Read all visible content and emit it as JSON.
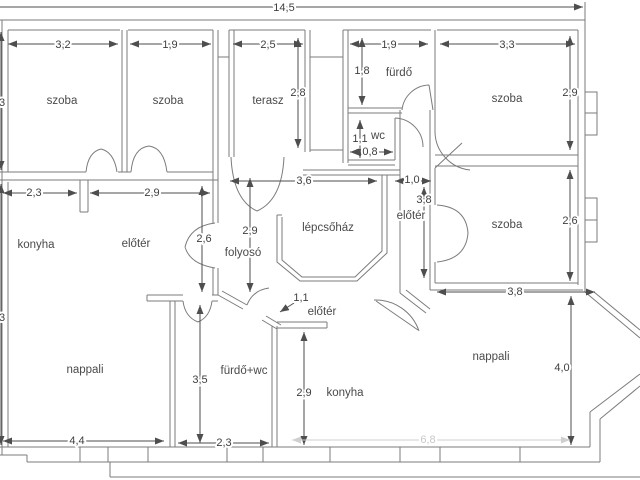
{
  "colors": {
    "wall": "#7b7b7b",
    "dim_line": "#4e4e4e",
    "text": "#4a4a4a",
    "faint": "#c8c8c8"
  },
  "floorplan": {
    "room_labels": {
      "szoba_tl": "szoba",
      "szoba_tm": "szoba",
      "terasz": "terasz",
      "furdo_top": "fürdő",
      "wc": "wc",
      "szoba_tr": "szoba",
      "szoba_mr": "szoba",
      "konyha_left": "konyha",
      "eloter_left": "előtér",
      "folyoso": "folyosó",
      "lepcsohaz": "lépcsőház",
      "eloter_right": "előtér",
      "eloter_bottom": "előtér",
      "nappali_left": "nappali",
      "furdo_wc": "fürdő+wc",
      "konyha_bottom": "konyha",
      "nappali_right": "nappali"
    },
    "dimensions": {
      "total_width": "14,5",
      "szoba_tl_w": "3,2",
      "szoba_tm_w": "1,9",
      "terasz_w": "2,5",
      "terasz_h": "2,8",
      "furdo_w": "1,9",
      "furdo_h": "1,8",
      "szoba_tr_w": "3,3",
      "szoba_tr_h": "2,9",
      "wc_h": "1,1",
      "wc_w": "0,8",
      "left_top": ",3",
      "left_bottom": ",3",
      "konyha_w": "2,3",
      "eloter_w": "2,9",
      "eloter_door": "2,6",
      "folyoso_h": "2,9",
      "lepcsohaz_w": "3,6",
      "corridor_w": "1,0",
      "corridor_h": "3,8",
      "szoba_mr_h": "2,6",
      "szoba_mr_w": "3,8",
      "entry_door": "1,1",
      "nappali_l_w": "4,4",
      "furdo_wc_h": "3,5",
      "furdo_wc_w": "2,3",
      "konyha_b_h": "2,9",
      "nappali_r_h": "4,0",
      "bottom_faint": "6,8"
    }
  }
}
